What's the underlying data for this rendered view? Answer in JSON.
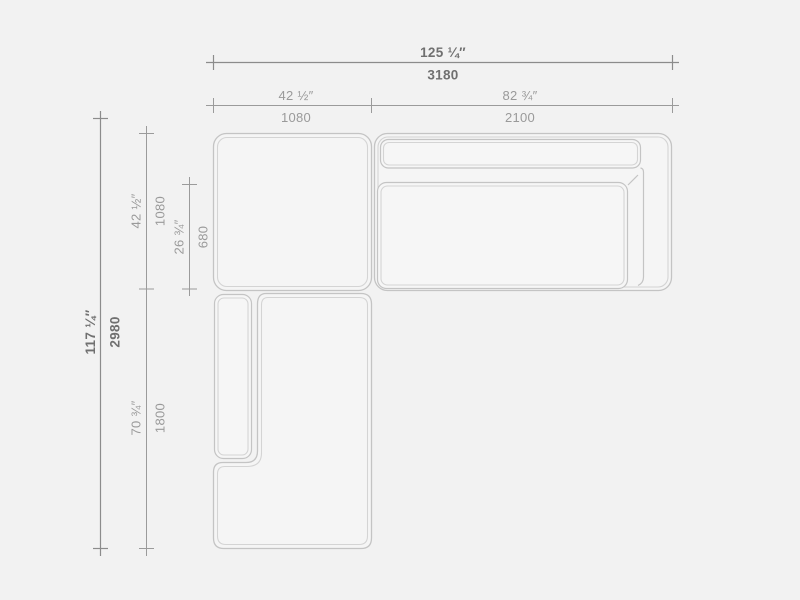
{
  "drawing": {
    "title": "sectional-sofa-plan",
    "colors": {
      "background": "#f2f2f2",
      "outline": "#c4c4c4",
      "outline_echo": "#d4d4d4",
      "dimension_line": "#9b9b9b",
      "dimension_primary_text": "#707070",
      "dimension_secondary_text": "#9a9a9a"
    },
    "dimensions": {
      "overall_width": {
        "inches": "125 ¼″",
        "mm": "3180"
      },
      "left_module_width": {
        "inches": "42 ½″",
        "mm": "1080"
      },
      "right_module_width": {
        "inches": "82 ¾″",
        "mm": "2100"
      },
      "overall_depth": {
        "inches": "117 ¼″",
        "mm": "2980"
      },
      "top_module_depth": {
        "inches": "42 ½″",
        "mm": "1080"
      },
      "seat_depth": {
        "inches": "26 ¾″",
        "mm": "680"
      },
      "chaise_length": {
        "inches": "70 ¾″",
        "mm": "1800"
      }
    }
  }
}
